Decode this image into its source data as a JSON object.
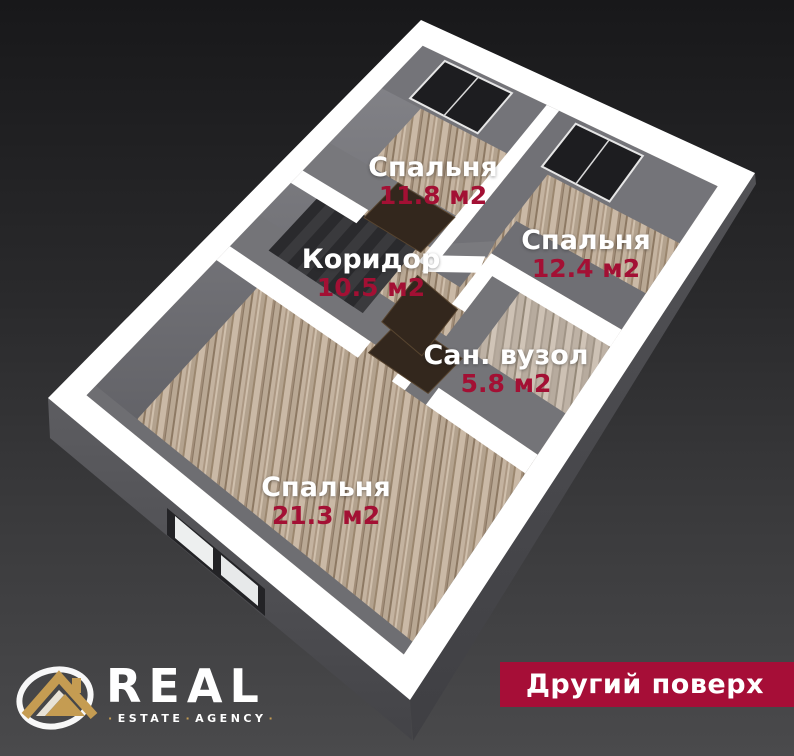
{
  "rooms": [
    {
      "name": "Спальня",
      "area": "11.8 м2"
    },
    {
      "name": "Спальня",
      "area": "12.4 м2"
    },
    {
      "name": "Коридор",
      "area": "10.5 м2"
    },
    {
      "name": "Сан. вузол",
      "area": "5.8 м2"
    },
    {
      "name": "Спальня",
      "area": "21.3 м2"
    }
  ],
  "badge": {
    "label": "Другий поверх"
  },
  "logo": {
    "title": "REAL",
    "subtitle_left": "ESTATE",
    "subtitle_right": "AGENCY",
    "separator": "·"
  },
  "colors": {
    "accent": "#a60e37",
    "area_text": "#a31034",
    "gold": "#c59c52",
    "background_top": "#18181a",
    "background_bottom": "#4a4a4c",
    "wall_top_white": "#ffffff",
    "wall_face_gray": "#76767a",
    "wood_base": "#bfae9a",
    "bath_wood_base": "#c4b8ab",
    "door": "#33271d",
    "window_glass": "#1d1d20"
  }
}
